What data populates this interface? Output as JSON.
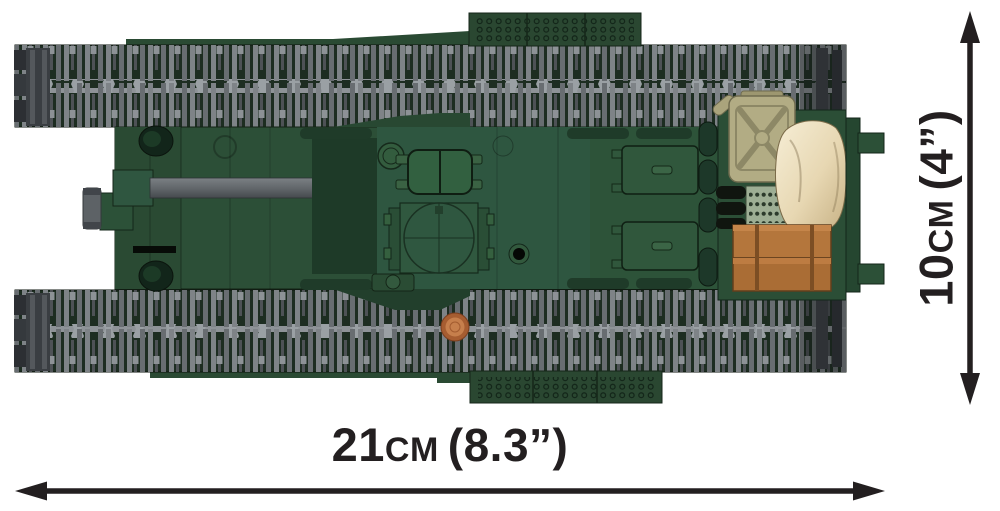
{
  "figure": {
    "name": "brick-built-tank-top-view"
  },
  "dimensions": {
    "width": {
      "value": "21",
      "unit": "CM",
      "imperial": "(8.3”)"
    },
    "height": {
      "value": "10",
      "unit": "CM",
      "imperial": "(4”)"
    }
  },
  "icons": {
    "width_arrow": "double-headed-arrow-horizontal",
    "height_arrow": "double-headed-arrow-vertical"
  },
  "colors": {
    "annotation": "#231f20",
    "background": "#ffffff",
    "hull_green": "#2c4f37",
    "hull_green_dark": "#1e3a28",
    "hull_green_deep": "#12251a",
    "track_base": "#1d2d21",
    "track_link": "#7e8387",
    "track_band": "#989da1",
    "gun_gray": "#62676b",
    "jerry_can": "#b2ac84",
    "sack": "#e9dab5",
    "crate": "#b4763c",
    "stud_copper": "#c67f4c"
  }
}
